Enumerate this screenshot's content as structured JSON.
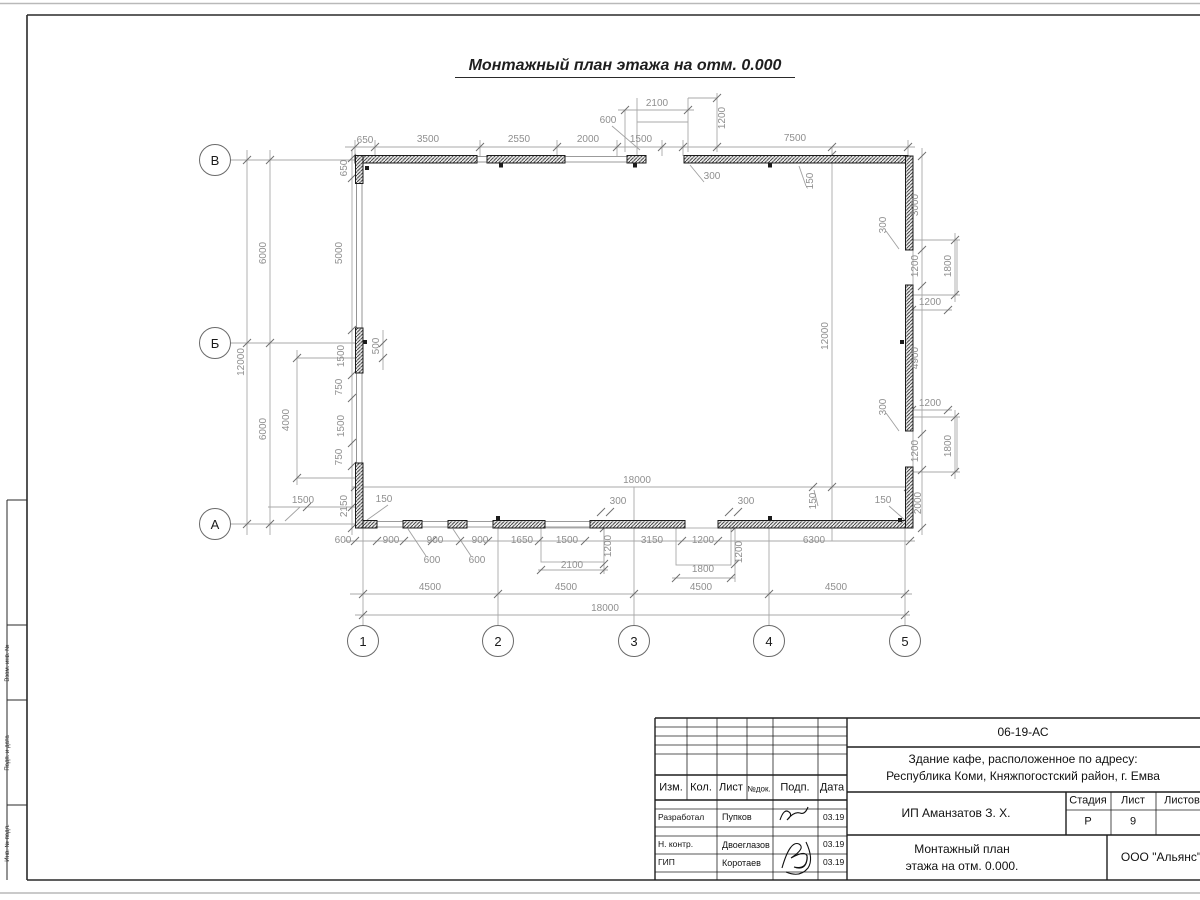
{
  "sheet": {
    "title": "Монтажный план этажа на отм. 0.000"
  },
  "stamp": {
    "code": "06-19-АС",
    "object_line1": "Здание кафе, расположенное по адресу:",
    "object_line2": "Республика Коми, Княжпогостский район, г. Емва",
    "client": "ИП Аманзатов З. Х.",
    "sheet_title_line1": "Монтажный план",
    "sheet_title_line2": "этажа на отм. 0.000.",
    "org": "ООО \"Альянс\"",
    "col_izm": "Изм.",
    "col_kol": "Кол.",
    "col_list": "Лист",
    "col_ndok": "№док.",
    "col_podp": "Подп.",
    "col_data": "Дата",
    "stadia_label": "Стадия",
    "list_label": "Лист",
    "listov_label": "Листов",
    "stadia_value": "Р",
    "list_value": "9",
    "listov_value": "",
    "rows": [
      {
        "role": "Разработал",
        "name": "Пупков",
        "date": "03.19"
      },
      {
        "role": "Н. контр.",
        "name": "Двоеглазов",
        "date": "03.19"
      },
      {
        "role": "ГИП",
        "name": "Коротаев",
        "date": "03.19"
      }
    ]
  },
  "margin": {
    "labels": [
      {
        "text": "Взам. инв. №",
        "y": 663
      },
      {
        "text": "Подп. и дата",
        "y": 753
      },
      {
        "text": "Инв. № подл.",
        "y": 843
      }
    ]
  },
  "axes": {
    "vertical": [
      {
        "label": "В",
        "x": 215,
        "y": 160
      },
      {
        "label": "Б",
        "x": 215,
        "y": 343
      },
      {
        "label": "А",
        "x": 215,
        "y": 524
      }
    ],
    "horizontal": [
      {
        "label": "1",
        "x": 363,
        "y": 641
      },
      {
        "label": "2",
        "x": 498,
        "y": 641
      },
      {
        "label": "3",
        "x": 634,
        "y": 641
      },
      {
        "label": "4",
        "x": 769,
        "y": 641
      },
      {
        "label": "5",
        "x": 905,
        "y": 641
      }
    ]
  },
  "dimensions": [
    {
      "t": "650",
      "x": 365,
      "y": 141
    },
    {
      "t": "3500",
      "x": 428,
      "y": 140
    },
    {
      "t": "2550",
      "x": 519,
      "y": 140
    },
    {
      "t": "2000",
      "x": 588,
      "y": 140
    },
    {
      "t": "1500",
      "x": 641,
      "y": 140
    },
    {
      "t": "7500",
      "x": 795,
      "y": 139
    },
    {
      "t": "2100",
      "x": 657,
      "y": 104
    },
    {
      "t": "600",
      "x": 608,
      "y": 121
    },
    {
      "t": "1200",
      "x": 723,
      "y": 118,
      "r": 1
    },
    {
      "t": "650",
      "x": 345,
      "y": 168,
      "r": 1
    },
    {
      "t": "300",
      "x": 712,
      "y": 177
    },
    {
      "t": "150",
      "x": 811,
      "y": 181,
      "r": 1
    },
    {
      "t": "3000",
      "x": 916,
      "y": 205,
      "r": 1
    },
    {
      "t": "300",
      "x": 884,
      "y": 225,
      "r": 1
    },
    {
      "t": "1200",
      "x": 916,
      "y": 266,
      "r": 1
    },
    {
      "t": "1800",
      "x": 949,
      "y": 266,
      "r": 1
    },
    {
      "t": "1200",
      "x": 930,
      "y": 303
    },
    {
      "t": "4900",
      "x": 916,
      "y": 358,
      "r": 1
    },
    {
      "t": "1200",
      "x": 930,
      "y": 404
    },
    {
      "t": "300",
      "x": 884,
      "y": 407,
      "r": 1
    },
    {
      "t": "1200",
      "x": 916,
      "y": 451,
      "r": 1
    },
    {
      "t": "1800",
      "x": 949,
      "y": 446,
      "r": 1
    },
    {
      "t": "150",
      "x": 883,
      "y": 501
    },
    {
      "t": "2000",
      "x": 919,
      "y": 503,
      "r": 1
    },
    {
      "t": "12000",
      "x": 826,
      "y": 336,
      "r": 1
    },
    {
      "t": "12000",
      "x": 242,
      "y": 362,
      "r": 1
    },
    {
      "t": "6000",
      "x": 264,
      "y": 253,
      "r": 1
    },
    {
      "t": "6000",
      "x": 264,
      "y": 429,
      "r": 1
    },
    {
      "t": "5000",
      "x": 340,
      "y": 253,
      "r": 1
    },
    {
      "t": "1500",
      "x": 342,
      "y": 356,
      "r": 1
    },
    {
      "t": "500",
      "x": 377,
      "y": 346,
      "r": 1
    },
    {
      "t": "750",
      "x": 340,
      "y": 387,
      "r": 1
    },
    {
      "t": "4000",
      "x": 287,
      "y": 420,
      "r": 1
    },
    {
      "t": "1500",
      "x": 342,
      "y": 426,
      "r": 1
    },
    {
      "t": "750",
      "x": 340,
      "y": 457,
      "r": 1
    },
    {
      "t": "2150",
      "x": 345,
      "y": 506,
      "r": 1
    },
    {
      "t": "1500",
      "x": 303,
      "y": 501
    },
    {
      "t": "150",
      "x": 384,
      "y": 500
    },
    {
      "t": "18000",
      "x": 637,
      "y": 481
    },
    {
      "t": "300",
      "x": 618,
      "y": 502
    },
    {
      "t": "300",
      "x": 746,
      "y": 502
    },
    {
      "t": "150",
      "x": 814,
      "y": 501,
      "r": 1
    },
    {
      "t": "600",
      "x": 343,
      "y": 541
    },
    {
      "t": "900",
      "x": 391,
      "y": 541
    },
    {
      "t": "900",
      "x": 435,
      "y": 541
    },
    {
      "t": "900",
      "x": 480,
      "y": 541
    },
    {
      "t": "1650",
      "x": 522,
      "y": 541
    },
    {
      "t": "1500",
      "x": 567,
      "y": 541
    },
    {
      "t": "1200",
      "x": 609,
      "y": 546,
      "r": 1
    },
    {
      "t": "3150",
      "x": 652,
      "y": 541
    },
    {
      "t": "1200",
      "x": 703,
      "y": 541
    },
    {
      "t": "1200",
      "x": 740,
      "y": 552,
      "r": 1
    },
    {
      "t": "6300",
      "x": 814,
      "y": 541
    },
    {
      "t": "600",
      "x": 432,
      "y": 561
    },
    {
      "t": "600",
      "x": 477,
      "y": 561
    },
    {
      "t": "2100",
      "x": 572,
      "y": 566
    },
    {
      "t": "1800",
      "x": 703,
      "y": 570
    },
    {
      "t": "4500",
      "x": 430,
      "y": 588
    },
    {
      "t": "4500",
      "x": 566,
      "y": 588
    },
    {
      "t": "4500",
      "x": 701,
      "y": 588
    },
    {
      "t": "4500",
      "x": 836,
      "y": 588
    },
    {
      "t": "18000",
      "x": 605,
      "y": 609
    }
  ]
}
